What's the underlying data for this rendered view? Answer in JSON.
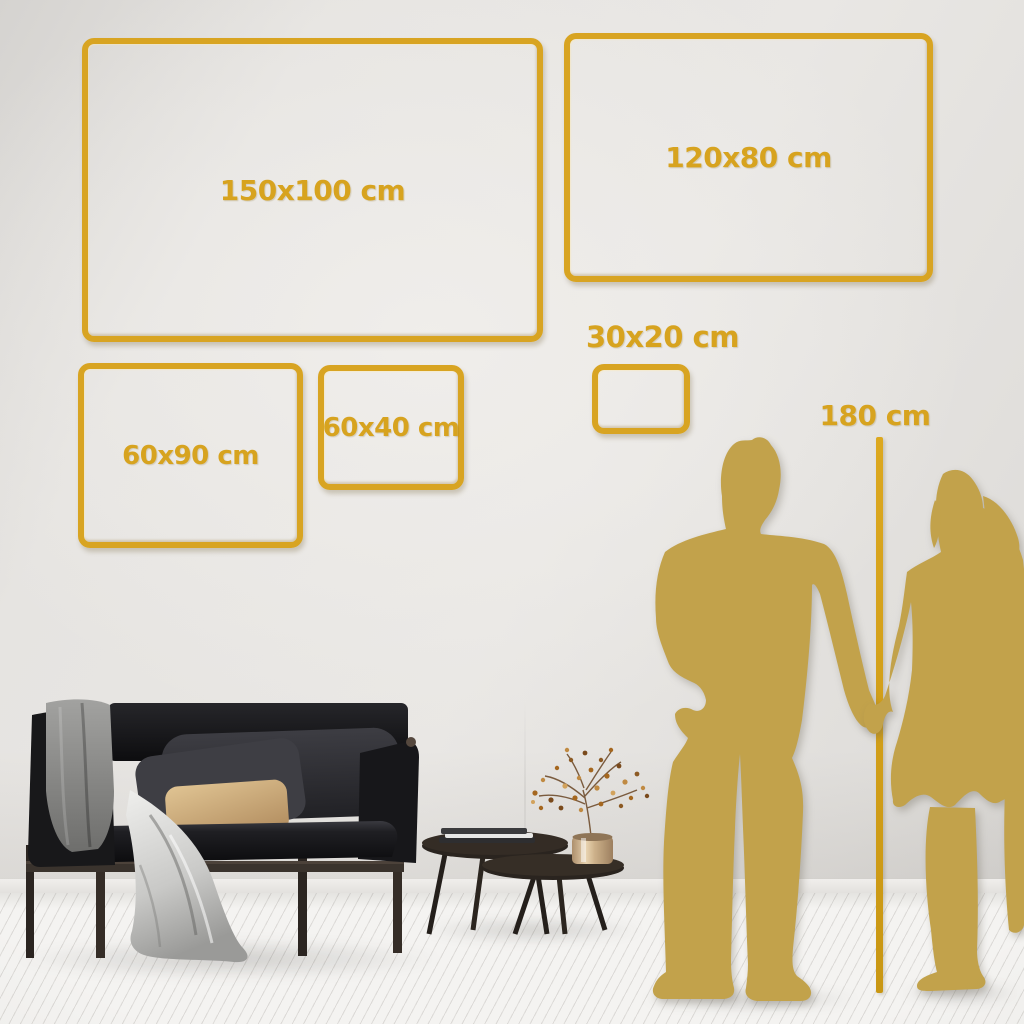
{
  "scene": {
    "accent_gold": "#D7A31F",
    "frame_gold": "#D8A422",
    "silhouette_gold": "#C2A24B"
  },
  "frames": [
    {
      "label": "150x100 cm"
    },
    {
      "label": "120x80 cm"
    },
    {
      "label": "60x90 cm"
    },
    {
      "label": "60x40 cm"
    },
    {
      "label": "30x20 cm"
    }
  ],
  "height_reference": {
    "label": "180 cm"
  }
}
